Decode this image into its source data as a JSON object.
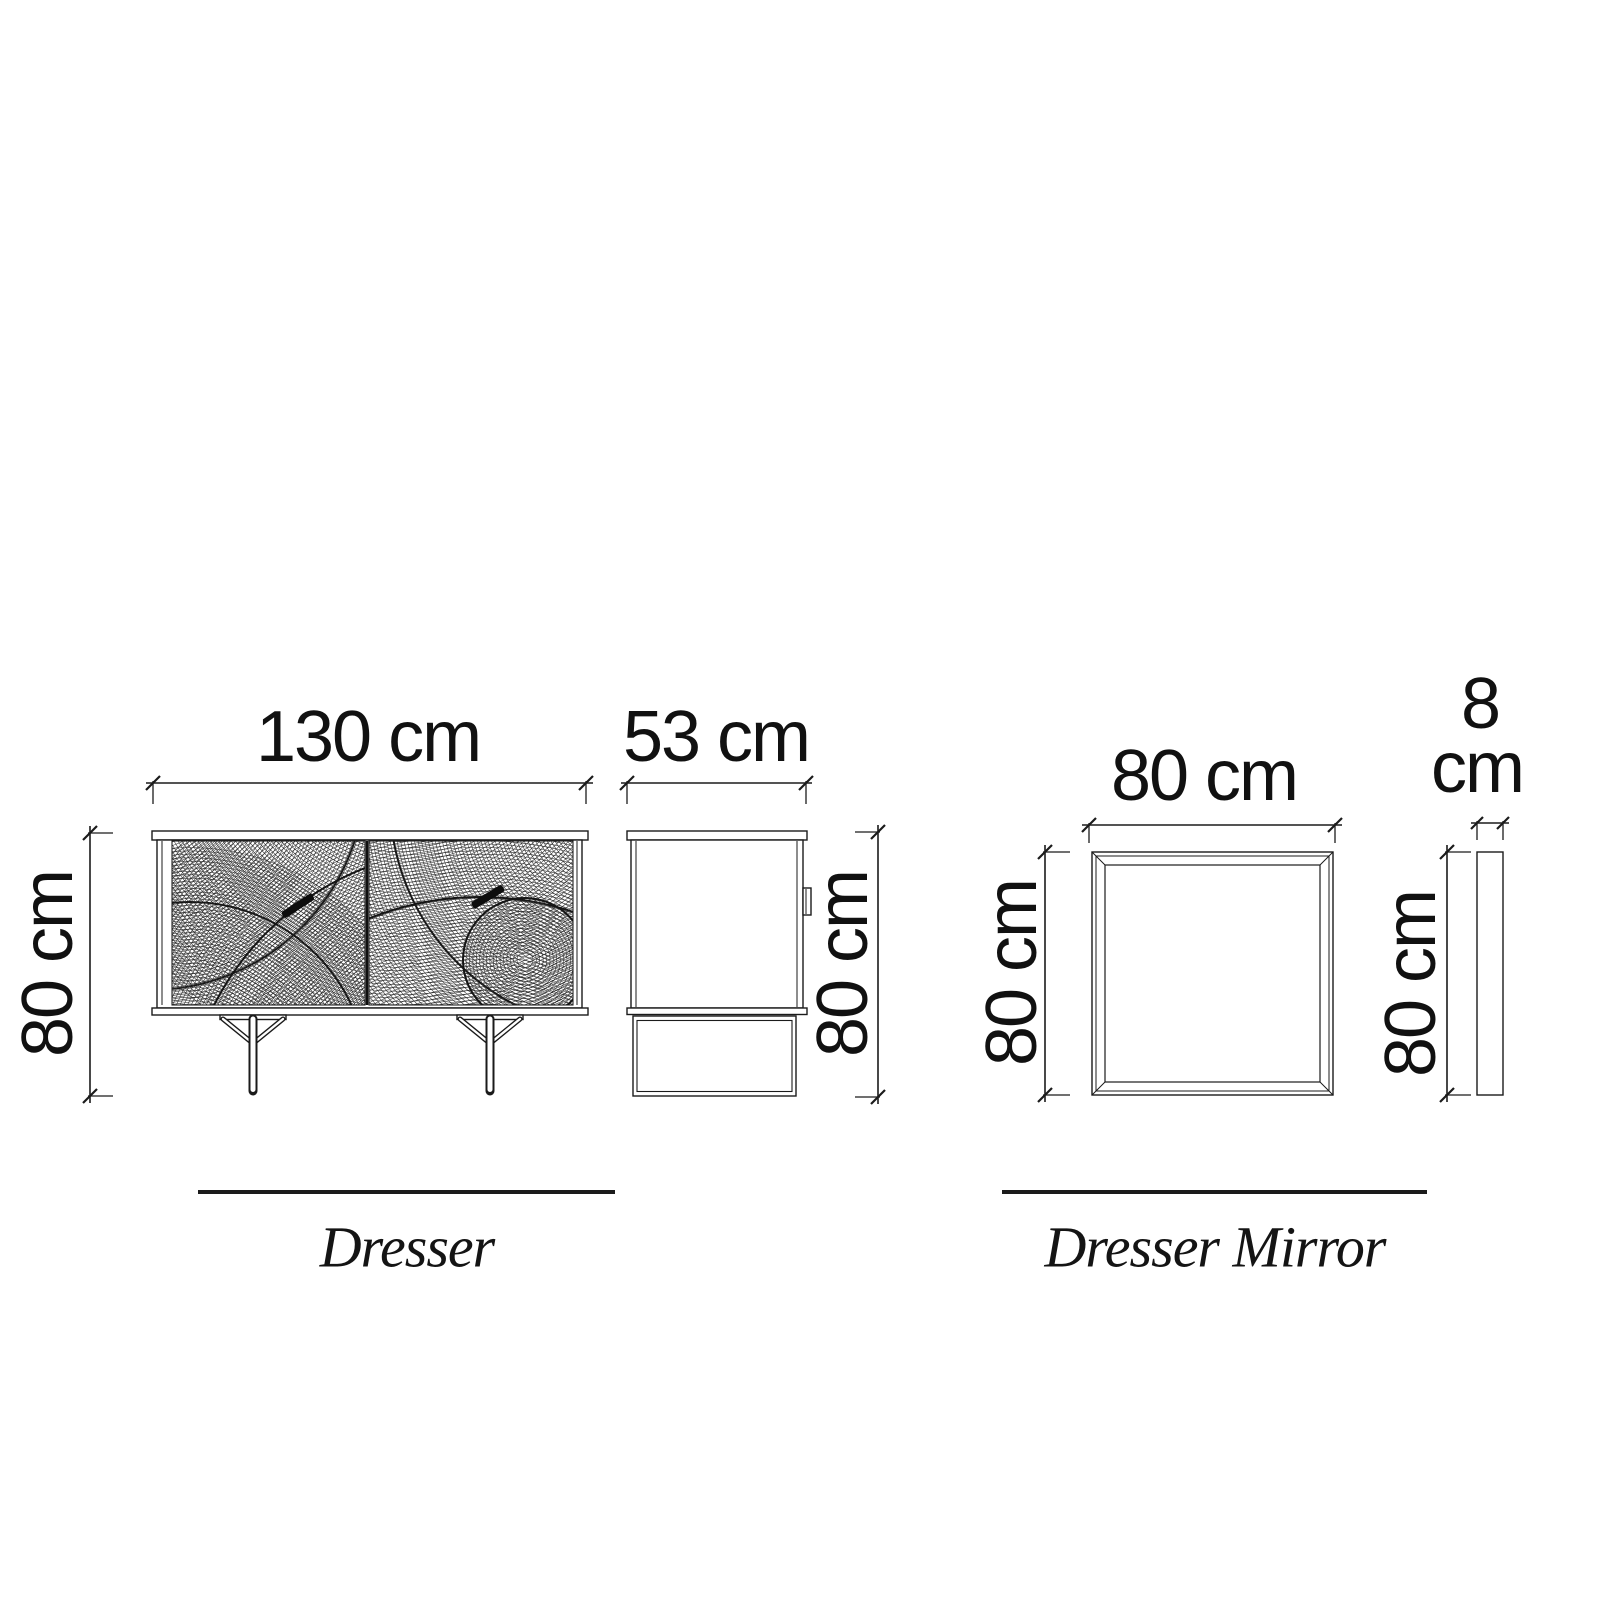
{
  "colors": {
    "background": "#ffffff",
    "line": "#1b1b1b",
    "text": "#111111",
    "handle": "#0d0d0d"
  },
  "dresser": {
    "label": "Dresser",
    "front_view": {
      "width": "130 cm",
      "height": "80 cm"
    },
    "side_view": {
      "depth": "53 cm",
      "height": "80 cm"
    }
  },
  "dresser_mirror": {
    "label": "Dresser Mirror",
    "front_view": {
      "width": "80 cm",
      "height": "80 cm"
    },
    "side_view": {
      "thickness_value": "8",
      "thickness_unit": "cm",
      "height": "80 cm"
    }
  }
}
